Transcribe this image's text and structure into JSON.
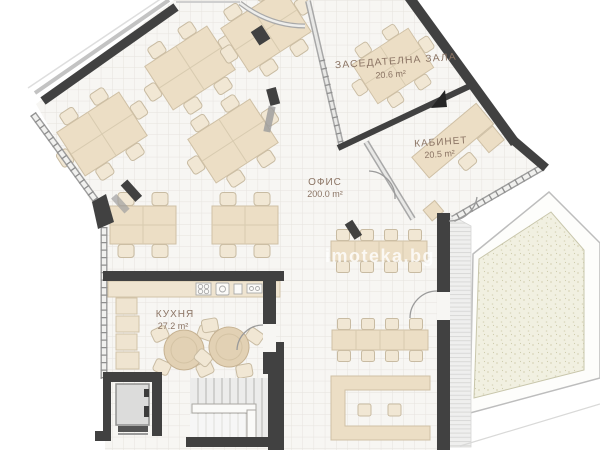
{
  "plan": {
    "watermark": "imoteka.bg",
    "rooms": [
      {
        "id": "meeting-room",
        "name": "ЗАСЕДАТЕЛНА ЗАЛА",
        "area": "20.6 m²"
      },
      {
        "id": "cabinet",
        "name": "КАБИНЕТ",
        "area": "20.5 m²"
      },
      {
        "id": "office",
        "name": "ОФИС",
        "area": "200.0 m²"
      },
      {
        "id": "kitchen",
        "name": "КУХНЯ",
        "area": "27.2 m²"
      }
    ],
    "colors": {
      "wall": "#414141",
      "glass_frame": "#9c9c9c",
      "floor": "#f7f6f3",
      "grid": "#e6e3de",
      "furniture": "#ecdec5",
      "furniture_stroke": "#cfc0a5",
      "label_text": "#8b7464",
      "terrace": "#f1f0e1"
    }
  }
}
